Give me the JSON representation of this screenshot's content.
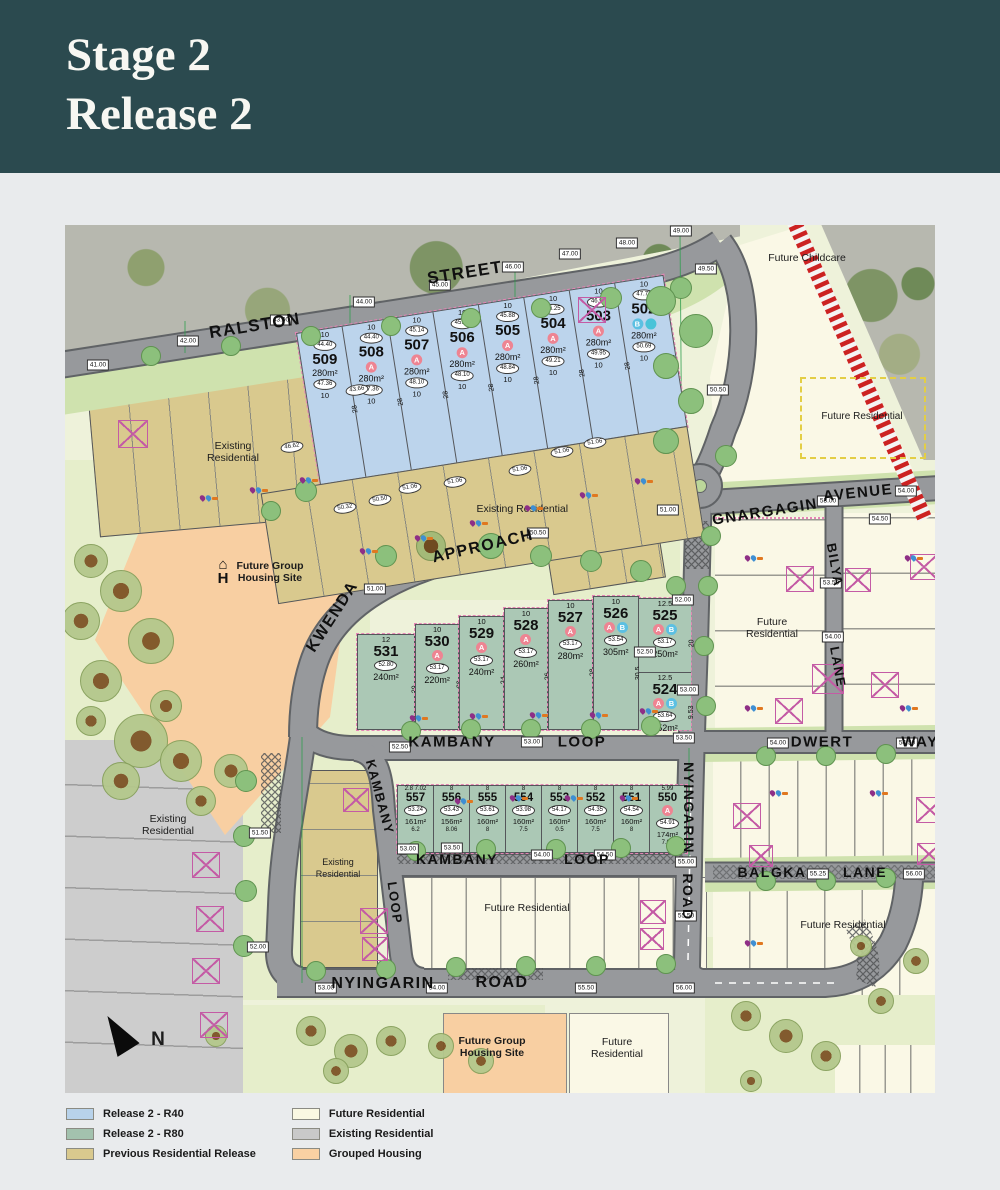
{
  "header": {
    "title_line1": "Stage 2",
    "title_line2": "Release 2"
  },
  "streets": {
    "ralston": "RALSTON",
    "street": "STREET",
    "kwenda": "KWENDA",
    "approach": "APPROACH",
    "gnargagin": "GNARGAGIN",
    "avenue": "AVENUE",
    "kambany": "KAMBANY",
    "loop": "LOOP",
    "nyingarin": "NYINGARIN",
    "road": "ROAD",
    "dwert": "DWERT",
    "way": "WAY",
    "bilya": "BILYA",
    "lane": "LANE",
    "balgka": "BALGKA"
  },
  "labels": {
    "future_childcare": "Future Childcare",
    "future_residential": "Future Residential",
    "existing_residential": "Existing Residential",
    "future_group_housing": "Future Group Housing Site",
    "north": "N"
  },
  "colors": {
    "r40": "#b8d2ea",
    "r80": "#a3c2ae",
    "previous": "#d9c98e",
    "future": "#faf8e2",
    "existing": "#c9c9c9",
    "grouped": "#f9d1a3",
    "road": "#97999c",
    "header": "#2b4a4f",
    "railway": "#cc2222"
  },
  "legend": {
    "items": [
      {
        "label": "Release 2 - R40",
        "color": "#b8d2ea"
      },
      {
        "label": "Release 2 - R80",
        "color": "#a3c2ae"
      },
      {
        "label": "Previous Residential Release",
        "color": "#d9c98e"
      },
      {
        "label": "Future Residential",
        "color": "#faf8e2"
      },
      {
        "label": "Existing Residential",
        "color": "#c9c9c9"
      },
      {
        "label": "Grouped Housing",
        "color": "#f9d1a3"
      }
    ]
  },
  "lots_r40": {
    "front_width": "10",
    "depth": "28",
    "rear_width": "10",
    "items": [
      {
        "n": "509",
        "front": "44.40",
        "rear": "47.36",
        "area": "280m²",
        "badges": []
      },
      {
        "n": "508",
        "front": "44.40",
        "rear": "47.36",
        "area": "280m²",
        "badges": [
          "A"
        ]
      },
      {
        "n": "507",
        "front": "45.14",
        "rear": "48.10",
        "area": "280m²",
        "badges": [
          "A"
        ]
      },
      {
        "n": "506",
        "front": "45.14",
        "rear": "48.10",
        "area": "280m²",
        "badges": [
          "A"
        ]
      },
      {
        "n": "505",
        "front": "45.88",
        "rear": "48.84",
        "area": "280m²",
        "badges": [
          "A"
        ]
      },
      {
        "n": "504",
        "front": "46.25",
        "rear": "49.21",
        "area": "280m²",
        "badges": [
          "A"
        ]
      },
      {
        "n": "503",
        "front": "46.99",
        "rear": "49.95",
        "area": "280m²",
        "badges": [
          "A"
        ]
      },
      {
        "n": "502",
        "front": "47.72",
        "rear": "50.69",
        "area": "280m²",
        "badges": [
          "B",
          "C"
        ]
      }
    ]
  },
  "lots_r80_upper": {
    "items": [
      {
        "n": "531",
        "chip": "52.80",
        "area": "240m²",
        "top": "12",
        "side": "20",
        "badges": [],
        "w": 58,
        "h": 94
      },
      {
        "n": "530",
        "chip": "53.17",
        "area": "220m²",
        "top": "10",
        "side": "22",
        "badges": [
          "A"
        ],
        "w": 44,
        "h": 104
      },
      {
        "n": "529",
        "chip": "53.17",
        "area": "240m²",
        "top": "10",
        "side": "24",
        "badges": [
          "A"
        ],
        "w": 44,
        "h": 112
      },
      {
        "n": "528",
        "chip": "53.17",
        "area": "260m²",
        "top": "10",
        "side": "26",
        "badges": [
          "A"
        ],
        "w": 44,
        "h": 120
      },
      {
        "n": "527",
        "chip": "53.17",
        "area": "280m²",
        "top": "10",
        "side": "28",
        "badges": [
          "A"
        ],
        "w": 44,
        "h": 128
      },
      {
        "n": "526",
        "chip": "53.54",
        "area": "305m²",
        "top": "10",
        "side": "30.5",
        "badges": [
          "A",
          "B"
        ],
        "w": 46,
        "h": 132
      },
      {
        "w": 54,
        "h": 132,
        "stack": [
          {
            "n": "525",
            "chip": "53.17",
            "area": "250m²",
            "top": "12.5",
            "side": "20",
            "badges": [
              "A",
              "B"
            ],
            "h": 74
          },
          {
            "n": "524",
            "chip": "53.64",
            "area": "152m²",
            "top": "12.5",
            "side": "9.53",
            "badges": [
              "A",
              "B"
            ],
            "h": 57
          }
        ]
      }
    ]
  },
  "lots_r80_lower": {
    "items": [
      {
        "n": "557",
        "chip": "53.24",
        "area": "161m²",
        "top": "2.8 7.02",
        "bot": "6.2",
        "side": "14.03",
        "badges": []
      },
      {
        "n": "556",
        "chip": "53.43",
        "area": "156m²",
        "top": "8",
        "bot": "8.06",
        "side": "19",
        "badges": []
      },
      {
        "n": "555",
        "chip": "53.61",
        "area": "160m²",
        "top": "8",
        "bot": "8",
        "side": "20",
        "badges": []
      },
      {
        "n": "554",
        "chip": "53.98",
        "area": "160m²",
        "top": "8",
        "bot": "7.5",
        "side": "20",
        "badges": []
      },
      {
        "n": "553",
        "chip": "54.17",
        "area": "160m²",
        "top": "8",
        "bot": "0.5",
        "side": "19",
        "badges": []
      },
      {
        "n": "552",
        "chip": "54.35",
        "area": "160m²",
        "top": "8",
        "bot": "7.5",
        "side": "20",
        "badges": []
      },
      {
        "n": "551",
        "chip": "54.54",
        "area": "160m²",
        "top": "8",
        "bot": "8",
        "side": "20",
        "badges": []
      },
      {
        "n": "550",
        "chip": "54.91",
        "area": "174m²",
        "top": "5.99",
        "bot": "7.02",
        "side": "15.01",
        "badges": [
          "A"
        ]
      }
    ]
  },
  "map": {
    "elevation_markers": [
      [
        33,
        140,
        "41.00"
      ],
      [
        123,
        116,
        "42.00"
      ],
      [
        216,
        95,
        "43.00"
      ],
      [
        299,
        77,
        "44.00"
      ],
      [
        375,
        60,
        "45.00"
      ],
      [
        448,
        42,
        "46.00"
      ],
      [
        505,
        29,
        "47.00"
      ],
      [
        562,
        18,
        "48.00"
      ],
      [
        616,
        6,
        "49.00"
      ],
      [
        641,
        44,
        "49.50"
      ],
      [
        653,
        165,
        "50.50"
      ],
      [
        603,
        285,
        "51.00"
      ],
      [
        763,
        276,
        "53.00"
      ],
      [
        841,
        266,
        "54.00"
      ],
      [
        815,
        294,
        "54.50"
      ],
      [
        310,
        364,
        "51.00"
      ],
      [
        473,
        308,
        "50.50"
      ],
      [
        195,
        608,
        "51.50"
      ],
      [
        193,
        722,
        "52.00"
      ],
      [
        261,
        763,
        "53.00"
      ],
      [
        372,
        763,
        "54.00"
      ],
      [
        521,
        763,
        "55.50"
      ],
      [
        619,
        763,
        "56.00"
      ],
      [
        618,
        375,
        "52.00"
      ],
      [
        580,
        427,
        "52.50"
      ],
      [
        623,
        465,
        "53.00"
      ],
      [
        619,
        513,
        "53.50"
      ],
      [
        467,
        517,
        "53.00"
      ],
      [
        335,
        522,
        "52.50"
      ],
      [
        343,
        624,
        "53.00"
      ],
      [
        387,
        623,
        "53.50"
      ],
      [
        477,
        630,
        "54.00"
      ],
      [
        540,
        630,
        "54.50"
      ],
      [
        713,
        518,
        "54.00"
      ],
      [
        842,
        518,
        "54.50"
      ],
      [
        766,
        358,
        "53.50"
      ],
      [
        768,
        412,
        "54.00"
      ],
      [
        753,
        649,
        "55.25"
      ],
      [
        849,
        649,
        "56.00"
      ],
      [
        621,
        637,
        "55.00"
      ],
      [
        621,
        691,
        "55.50"
      ]
    ],
    "chips": [
      [
        227,
        222,
        "46.62"
      ],
      [
        292,
        165,
        "43.66"
      ],
      [
        390,
        257,
        "51.06"
      ],
      [
        455,
        245,
        "51.06"
      ],
      [
        497,
        227,
        "51.06"
      ],
      [
        530,
        218,
        "51.06"
      ],
      [
        280,
        283,
        "50.32"
      ],
      [
        315,
        275,
        "50.50"
      ],
      [
        345,
        263,
        "51.06"
      ]
    ],
    "xboxes": [
      [
        53,
        195,
        28
      ],
      [
        513,
        72,
        26
      ],
      [
        278,
        563,
        24
      ],
      [
        127,
        627,
        26
      ],
      [
        131,
        681,
        26
      ],
      [
        127,
        733,
        26
      ],
      [
        135,
        787,
        26
      ],
      [
        295,
        683,
        26
      ],
      [
        297,
        712,
        24
      ],
      [
        721,
        341,
        26
      ],
      [
        780,
        343,
        24
      ],
      [
        845,
        329,
        26
      ],
      [
        747,
        439,
        30
      ],
      [
        806,
        447,
        26
      ],
      [
        710,
        473,
        26
      ],
      [
        668,
        578,
        26
      ],
      [
        684,
        620,
        22
      ],
      [
        851,
        572,
        26
      ],
      [
        852,
        618,
        22
      ],
      [
        575,
        675,
        24
      ],
      [
        575,
        703,
        22
      ]
    ],
    "trees": [
      [
        25,
        335,
        16,
        "o"
      ],
      [
        55,
        365,
        20,
        "o"
      ],
      [
        15,
        395,
        18,
        "o"
      ],
      [
        85,
        415,
        22,
        "o"
      ],
      [
        35,
        455,
        20,
        "o"
      ],
      [
        100,
        480,
        15,
        "o"
      ],
      [
        75,
        515,
        26,
        "o"
      ],
      [
        115,
        535,
        20,
        "o"
      ],
      [
        25,
        495,
        14,
        "o"
      ],
      [
        165,
        545,
        16,
        "o"
      ],
      [
        55,
        555,
        18,
        "o"
      ],
      [
        135,
        575,
        14,
        "o"
      ],
      [
        85,
        130,
        9,
        "g"
      ],
      [
        165,
        120,
        9,
        "g"
      ],
      [
        245,
        110,
        9,
        "g"
      ],
      [
        325,
        100,
        9,
        "g"
      ],
      [
        405,
        92,
        9,
        "g"
      ],
      [
        475,
        82,
        9,
        "g"
      ],
      [
        545,
        72,
        10,
        "g"
      ],
      [
        615,
        62,
        10,
        "g"
      ],
      [
        595,
        75,
        14,
        "g"
      ],
      [
        630,
        105,
        16,
        "g"
      ],
      [
        600,
        140,
        12,
        "g"
      ],
      [
        625,
        175,
        12,
        "g"
      ],
      [
        600,
        215,
        12,
        "g"
      ],
      [
        660,
        230,
        10,
        "g"
      ],
      [
        240,
        265,
        10,
        "g"
      ],
      [
        205,
        285,
        9,
        "g"
      ],
      [
        365,
        320,
        14,
        "b"
      ],
      [
        320,
        330,
        10,
        "g"
      ],
      [
        425,
        320,
        12,
        "g"
      ],
      [
        475,
        330,
        10,
        "g"
      ],
      [
        525,
        335,
        10,
        "g"
      ],
      [
        575,
        345,
        10,
        "g"
      ],
      [
        610,
        360,
        9,
        "g"
      ],
      [
        345,
        505,
        9,
        "g"
      ],
      [
        405,
        503,
        9,
        "g"
      ],
      [
        465,
        503,
        9,
        "g"
      ],
      [
        525,
        503,
        9,
        "g"
      ],
      [
        585,
        500,
        9,
        "g"
      ],
      [
        640,
        480,
        9,
        "g"
      ],
      [
        638,
        420,
        9,
        "g"
      ],
      [
        642,
        360,
        9,
        "g"
      ],
      [
        645,
        310,
        9,
        "g"
      ],
      [
        350,
        625,
        9,
        "g"
      ],
      [
        420,
        623,
        9,
        "g"
      ],
      [
        490,
        623,
        9,
        "g"
      ],
      [
        555,
        622,
        9,
        "g"
      ],
      [
        610,
        620,
        9,
        "g"
      ],
      [
        250,
        745,
        9,
        "g"
      ],
      [
        320,
        743,
        9,
        "g"
      ],
      [
        390,
        741,
        9,
        "g"
      ],
      [
        460,
        740,
        9,
        "g"
      ],
      [
        530,
        740,
        9,
        "g"
      ],
      [
        600,
        738,
        9,
        "g"
      ],
      [
        245,
        805,
        14,
        "o"
      ],
      [
        285,
        825,
        16,
        "o"
      ],
      [
        325,
        815,
        14,
        "o"
      ],
      [
        270,
        845,
        12,
        "o"
      ],
      [
        375,
        820,
        12,
        "o"
      ],
      [
        415,
        835,
        12,
        "o"
      ],
      [
        150,
        810,
        10,
        "o"
      ],
      [
        680,
        790,
        14,
        "o"
      ],
      [
        720,
        810,
        16,
        "o"
      ],
      [
        760,
        830,
        14,
        "o"
      ],
      [
        815,
        775,
        12,
        "o"
      ],
      [
        850,
        735,
        12,
        "o"
      ],
      [
        795,
        720,
        10,
        "o"
      ],
      [
        685,
        855,
        10,
        "o"
      ],
      [
        700,
        530,
        9,
        "g"
      ],
      [
        760,
        530,
        9,
        "g"
      ],
      [
        820,
        528,
        9,
        "g"
      ],
      [
        700,
        655,
        9,
        "g"
      ],
      [
        760,
        655,
        9,
        "g"
      ],
      [
        820,
        652,
        9,
        "g"
      ],
      [
        180,
        555,
        10,
        "g"
      ],
      [
        178,
        610,
        10,
        "g"
      ],
      [
        180,
        665,
        10,
        "g"
      ],
      [
        178,
        720,
        10,
        "g"
      ]
    ],
    "services": [
      [
        295,
        323
      ],
      [
        350,
        310
      ],
      [
        405,
        295
      ],
      [
        460,
        280
      ],
      [
        515,
        267
      ],
      [
        570,
        253
      ],
      [
        345,
        490
      ],
      [
        405,
        488
      ],
      [
        465,
        487
      ],
      [
        525,
        487
      ],
      [
        575,
        483
      ],
      [
        390,
        573
      ],
      [
        445,
        570
      ],
      [
        500,
        570
      ],
      [
        555,
        570
      ],
      [
        680,
        330
      ],
      [
        840,
        330
      ],
      [
        680,
        480
      ],
      [
        835,
        480
      ],
      [
        705,
        565
      ],
      [
        805,
        565
      ],
      [
        680,
        715
      ],
      [
        135,
        270
      ],
      [
        185,
        262
      ],
      [
        235,
        252
      ]
    ]
  }
}
